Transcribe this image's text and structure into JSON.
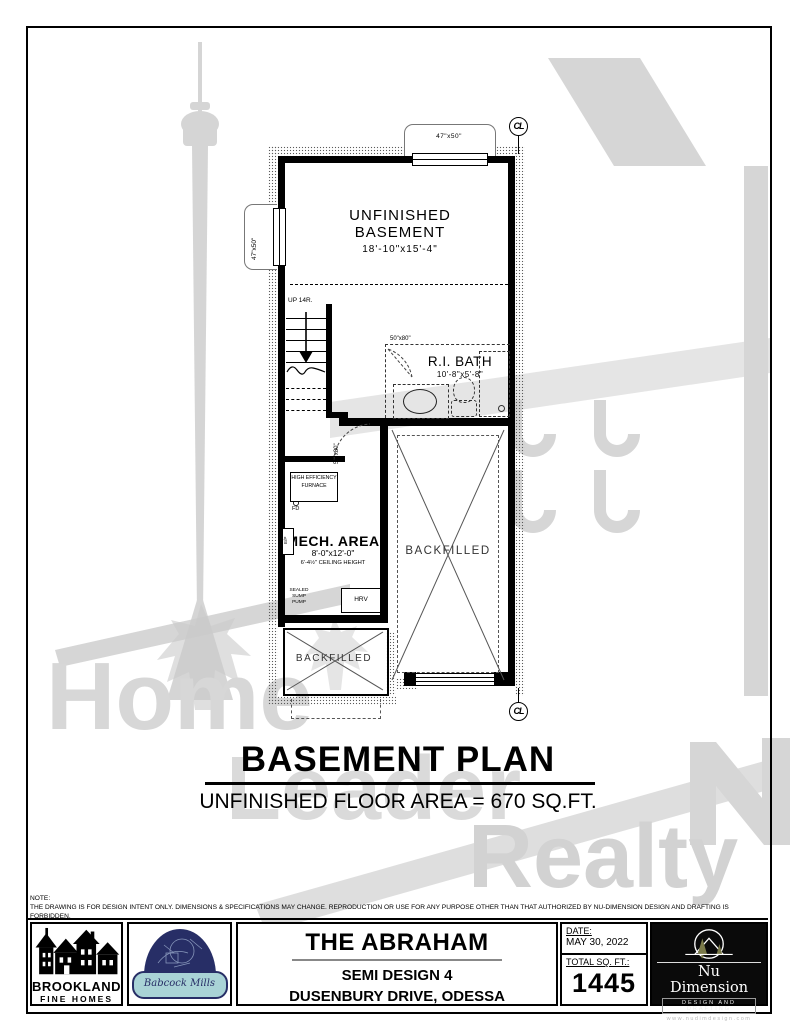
{
  "watermark": {
    "home": "Home",
    "leader": "Leader",
    "realty": "Realty"
  },
  "plan": {
    "cl": "CL",
    "window_top": "47\"x50\"",
    "window_left": "47\"x50\"",
    "stairs_up": "UP 14R.",
    "basement_line1": "UNFINISHED",
    "basement_line2": "BASEMENT",
    "basement_dims": "18'-10\"x15'-4\"",
    "bath_name": "R.I. BATH",
    "bath_dims": "10'-8\"x5'-8\"",
    "bath_door": "50\"x80\"",
    "stair_door": "50\"x80\"",
    "furnace": "HIGH EFFICIENCY FURNACE",
    "floor_drain": "FD",
    "mech_name": "MECH. AREA",
    "mech_dims": "8'-0\"x12'-0\"",
    "mech_ceiling": "6'-4½\" CEILING HEIGHT",
    "panel": "E/P",
    "sump": "SEALED SUMP PUMP",
    "hrv": "HRV",
    "backfilled_right": "BACKFILLED",
    "backfilled_porch": "BACKFILLED"
  },
  "title": {
    "main": "BASEMENT PLAN",
    "sub": "UNFINISHED FLOOR AREA = 670 SQ.FT."
  },
  "note": {
    "label": "NOTE:",
    "text": "THE DRAWING IS FOR DESIGN INTENT ONLY. DIMENSIONS & SPECIFICATIONS MAY CHANGE. REPRODUCTION OR USE FOR ANY PURPOSE OTHER THAN THAT AUTHORIZED BY NU-DIMENSION DESIGN AND DRAFTING IS FORBIDDEN."
  },
  "footer": {
    "brookland_name": "BROOKLAND",
    "brookland_sub": "FINE HOMES",
    "babcock": "Babcock Mills",
    "project_name": "THE ABRAHAM",
    "project_model": "SEMI DESIGN 4",
    "project_address": "DUSENBURY DRIVE, ODESSA",
    "date_label": "DATE:",
    "date_value": "MAY 30, 2022",
    "sqft_label": "TOTAL SQ. FT.:",
    "sqft_value": "1445",
    "nudim_name": "Nu Dimension",
    "nudim_tagline": "DESIGN AND DRAFTING",
    "nudim_web": "www.nudimdesign.com"
  },
  "colors": {
    "navy": "#272e66",
    "teal": "#a9d3d6",
    "watermark_gray": "#cfcfcf",
    "tree_olive": "#7a7a4a"
  }
}
